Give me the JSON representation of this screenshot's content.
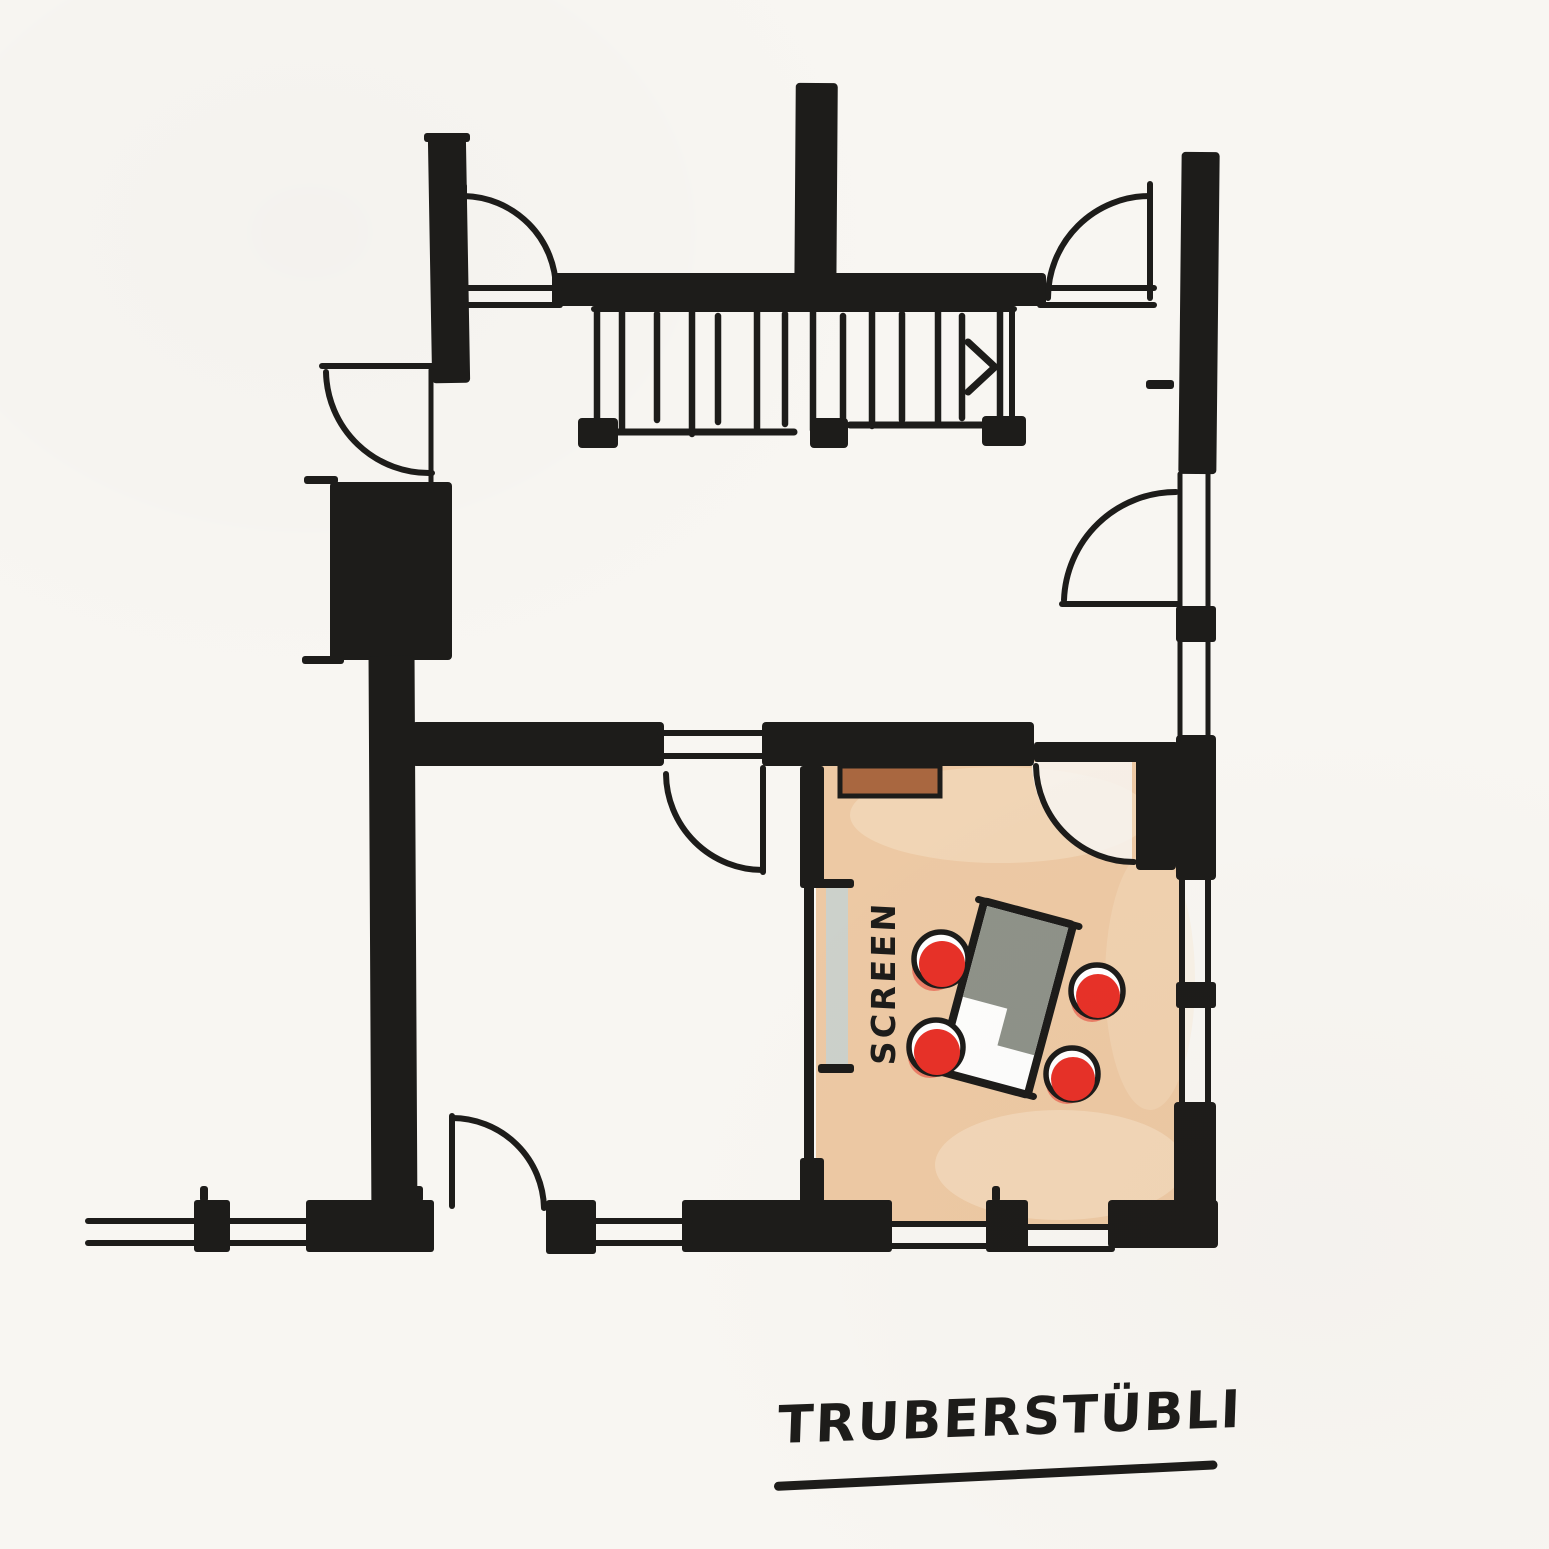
{
  "labels": {
    "title": "TRUBERSTÜBLI",
    "screen": "SCREEN"
  },
  "colors": {
    "ink": "#1d1c1a",
    "paper": "#f8f6f2",
    "room_fill": "#edc9a4",
    "room_fill_light": "#f7e4c9",
    "chair_red": "#e73128",
    "sideboard_brown": "#a96740",
    "table_gray": "#8e9289",
    "table_white": "#fdfdfc",
    "screen_gray": "#ccd1cb"
  }
}
